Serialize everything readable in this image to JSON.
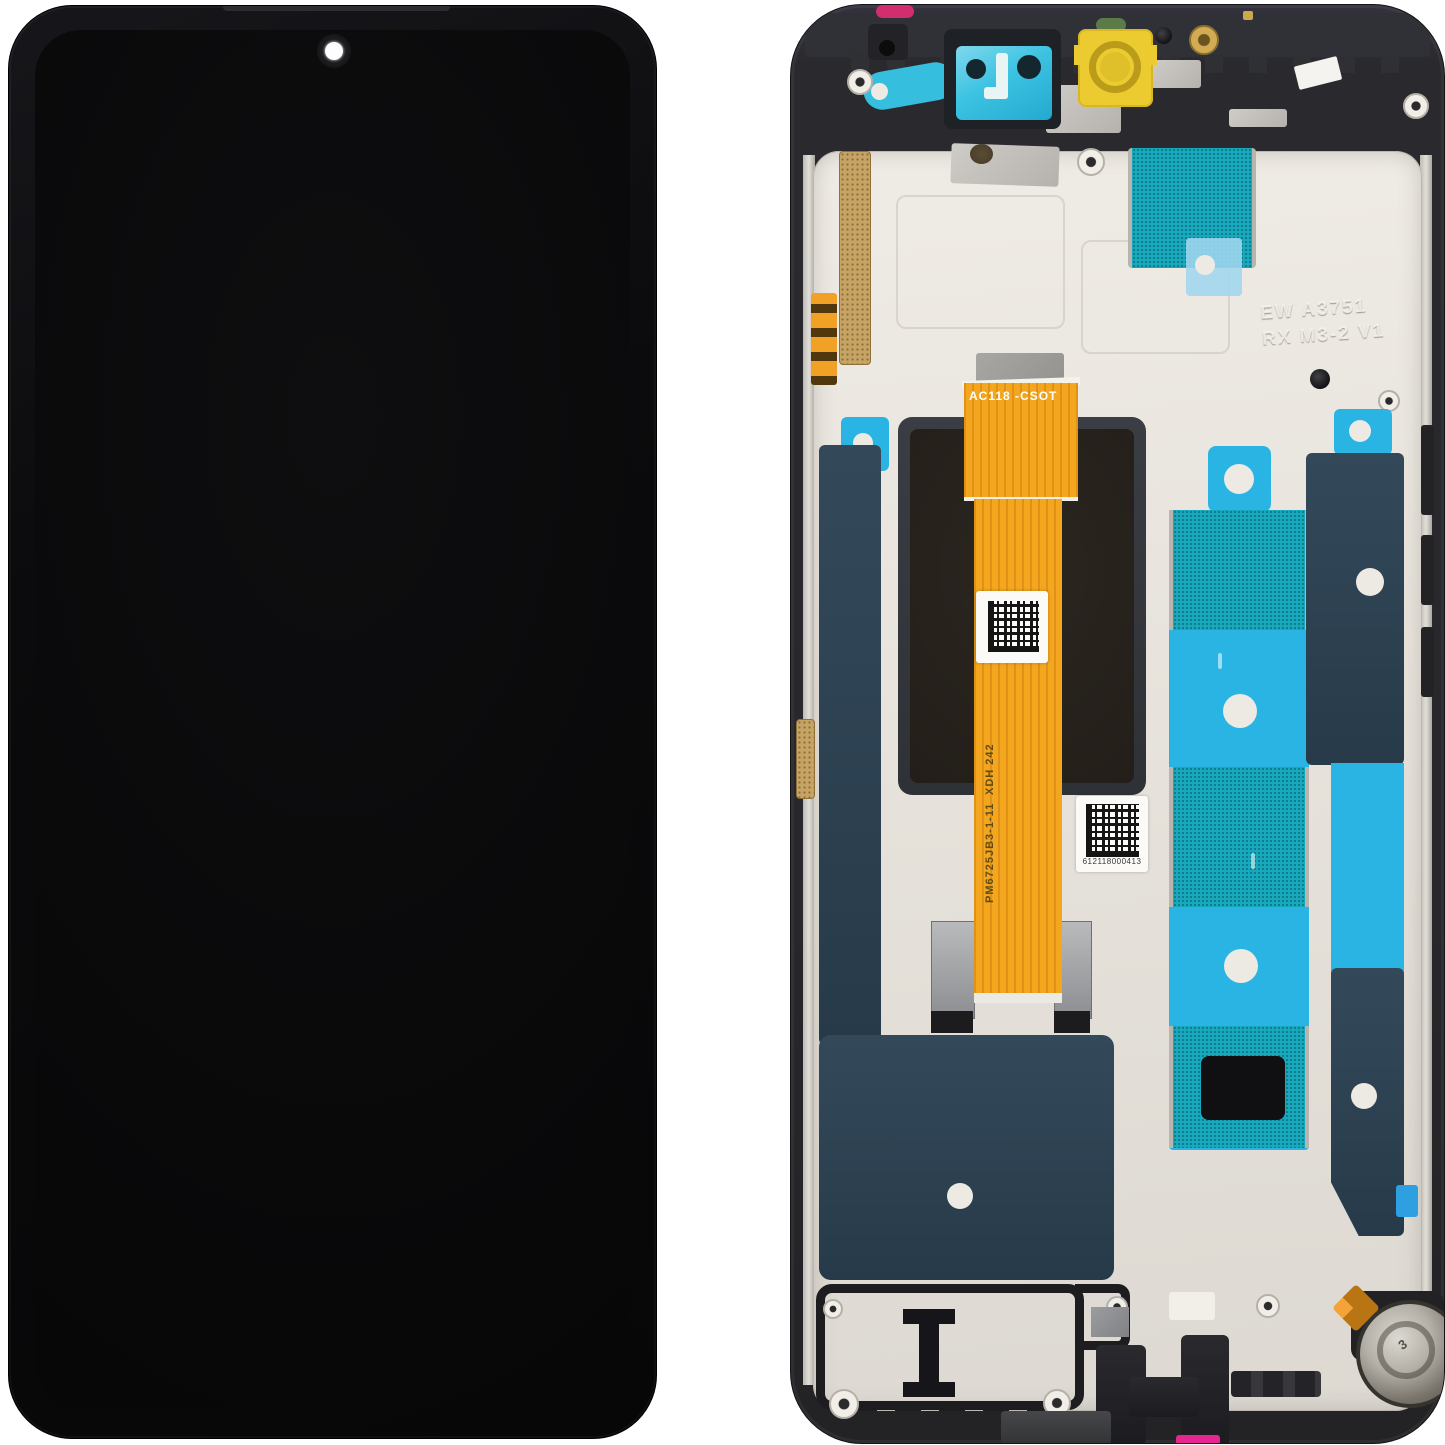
{
  "front_view": {
    "body_color": "#0b0b0d",
    "screen_color": "#09090a",
    "camera_hole_color": "#fdfdfd"
  },
  "back_view": {
    "frame_color": "#28282c",
    "plate_color": "#e8e4dd",
    "accents": {
      "flex_orange": "#f3a61e",
      "adhesive_navy": "#2c4050",
      "adhesive_cyan": "#2ab4e4",
      "mesh_teal": "#17a9bd",
      "gold_mesh": "#c6a465",
      "magenta_top": "#d12e6e",
      "magenta_bottom": "#e4268f",
      "lens_cover_yellow": "#eccb31",
      "camera_film_cyan": "#3cc3e2"
    },
    "markings": {
      "flex_top_label": "AC118  -CSOT",
      "connector_label": "CN2",
      "pin_left_top": "20",
      "pin_left_bottom": "21",
      "pin_right_top": "1",
      "pin_right_bottom": "40",
      "flex_vertical_label": "PM6725JB3-1-11",
      "flex_vertical_sublabel": "XDH 242",
      "serial_number": "612118000413",
      "etched_line1": "EW A3751",
      "etched_line2": "RX M3-2 V1",
      "motor_stamp": "3"
    }
  }
}
